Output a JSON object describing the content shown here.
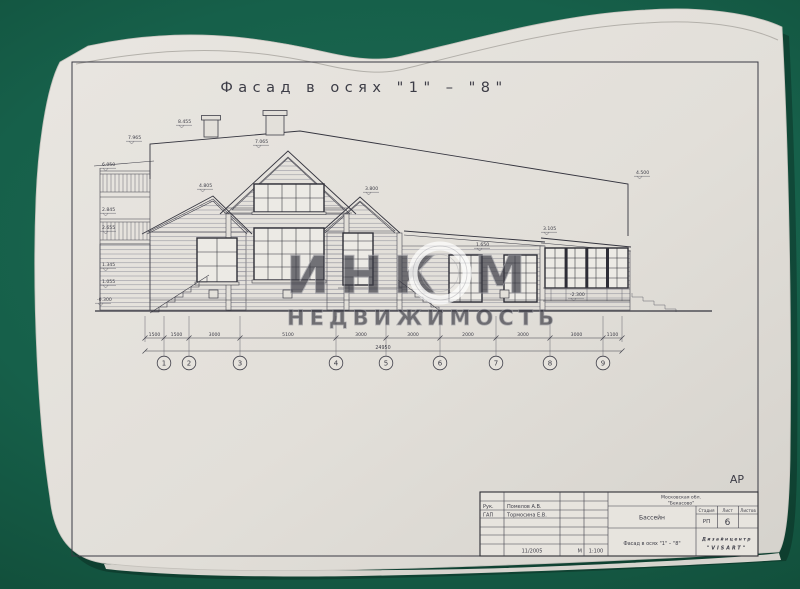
{
  "surface": {
    "color": "#16604a"
  },
  "paper": {
    "color": "#e3e0da"
  },
  "title": {
    "text": "Фасад в осях \"1\" – \"8\""
  },
  "section_code": "АР",
  "watermark": {
    "part1": "ИНК",
    "part2": "М",
    "line2": "НЕДВИЖИМОСТЬ"
  },
  "drawing": {
    "axis_labels": [
      "1",
      "2",
      "3",
      "4",
      "5",
      "6",
      "7",
      "8",
      "9"
    ],
    "dimension_labels": [
      "1500",
      "1500",
      "3000",
      "5100",
      "3000",
      "3000",
      "2000",
      "3000",
      "3000",
      "1100"
    ],
    "total_dimension": "24950",
    "elevation_marks": [
      {
        "value": "8.455"
      },
      {
        "value": "7.965"
      },
      {
        "value": "6.050"
      },
      {
        "value": "2.845"
      },
      {
        "value": "2.655"
      },
      {
        "value": "1.345"
      },
      {
        "value": "1.055"
      },
      {
        "value": "-0.300"
      },
      {
        "value": "7.065"
      },
      {
        "value": "4.805"
      },
      {
        "value": "3.800"
      },
      {
        "value": "4.500"
      },
      {
        "value": "3.105"
      },
      {
        "value": "1.650"
      },
      {
        "value": "-2.300"
      }
    ]
  },
  "stamp": {
    "role1_label": "Рук.",
    "role1_name": "Помелов А.В.",
    "role2_label": "ГАП",
    "role2_name": "Тормосина Е.В.",
    "date": "11/2005",
    "scale_prefix": "М",
    "scale_value": "1:100",
    "region": "Московская обл.",
    "site": "\"Бекасово\"",
    "object_name": "Бассейн",
    "stage_label": "Стадия",
    "sheet_label": "Лист",
    "sheets_label": "Листов",
    "stage_value": "РП",
    "sheet_value": "6",
    "sheets_value": "",
    "drawing_title": "Фасад в осях \"1\" – \"8\"",
    "company_line1": "Дизайнцентр",
    "company_line2": "\"VISART\""
  }
}
